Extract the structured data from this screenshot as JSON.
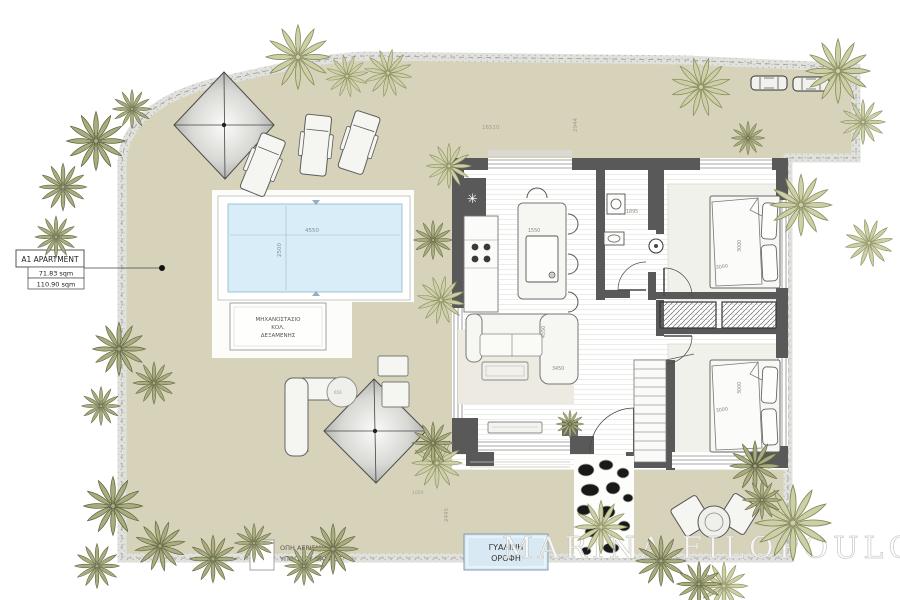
{
  "plan": {
    "title_box": {
      "name": "A1 APARTMENT",
      "area_net": "71.83 sqm",
      "area_total": "110.90 sqm"
    },
    "pool": {
      "length": "4550",
      "width": "2500"
    },
    "pump_room": {
      "line1": "ΜΗΧΑΝΟΣΤΑΣΙΟ",
      "line2": "ΚΟΛ.",
      "line3": "ΔΕΞΑΜΕΝΗΣ"
    },
    "garage_vent": {
      "line1": "ΟΠΗ ΑΕΡΙΣΜΟΥ",
      "line2": "ΥΠΟΓΕΙΟΥ GARAGE"
    },
    "glass_roof": {
      "line1": "ΓΥΑΛΙΝΗ",
      "line2": "ΟΡΟΦΗ"
    },
    "dimensions": {
      "site_top": "16510",
      "site_right": "2944",
      "garden_left": "2445",
      "garden_bottom": "1050",
      "island": "1550",
      "bathroom": "1895",
      "bed1_depth": "3000",
      "bed1_width": "3000",
      "bed2_depth": "3000",
      "bed2_width": "3000",
      "living_depth": "4550",
      "living_width": "3450",
      "round_table": "650"
    },
    "watermark": "MARINA FILOPOULOU",
    "colors": {
      "garden": "#d7d3ba",
      "boundary": "#e1e1de",
      "pool": "#d8edf8",
      "wall": "#595959",
      "tree_olive": "#a9ac7c",
      "tree_light": "#cdcfa6",
      "glass_roof_fill": "#d9e9f3"
    }
  }
}
